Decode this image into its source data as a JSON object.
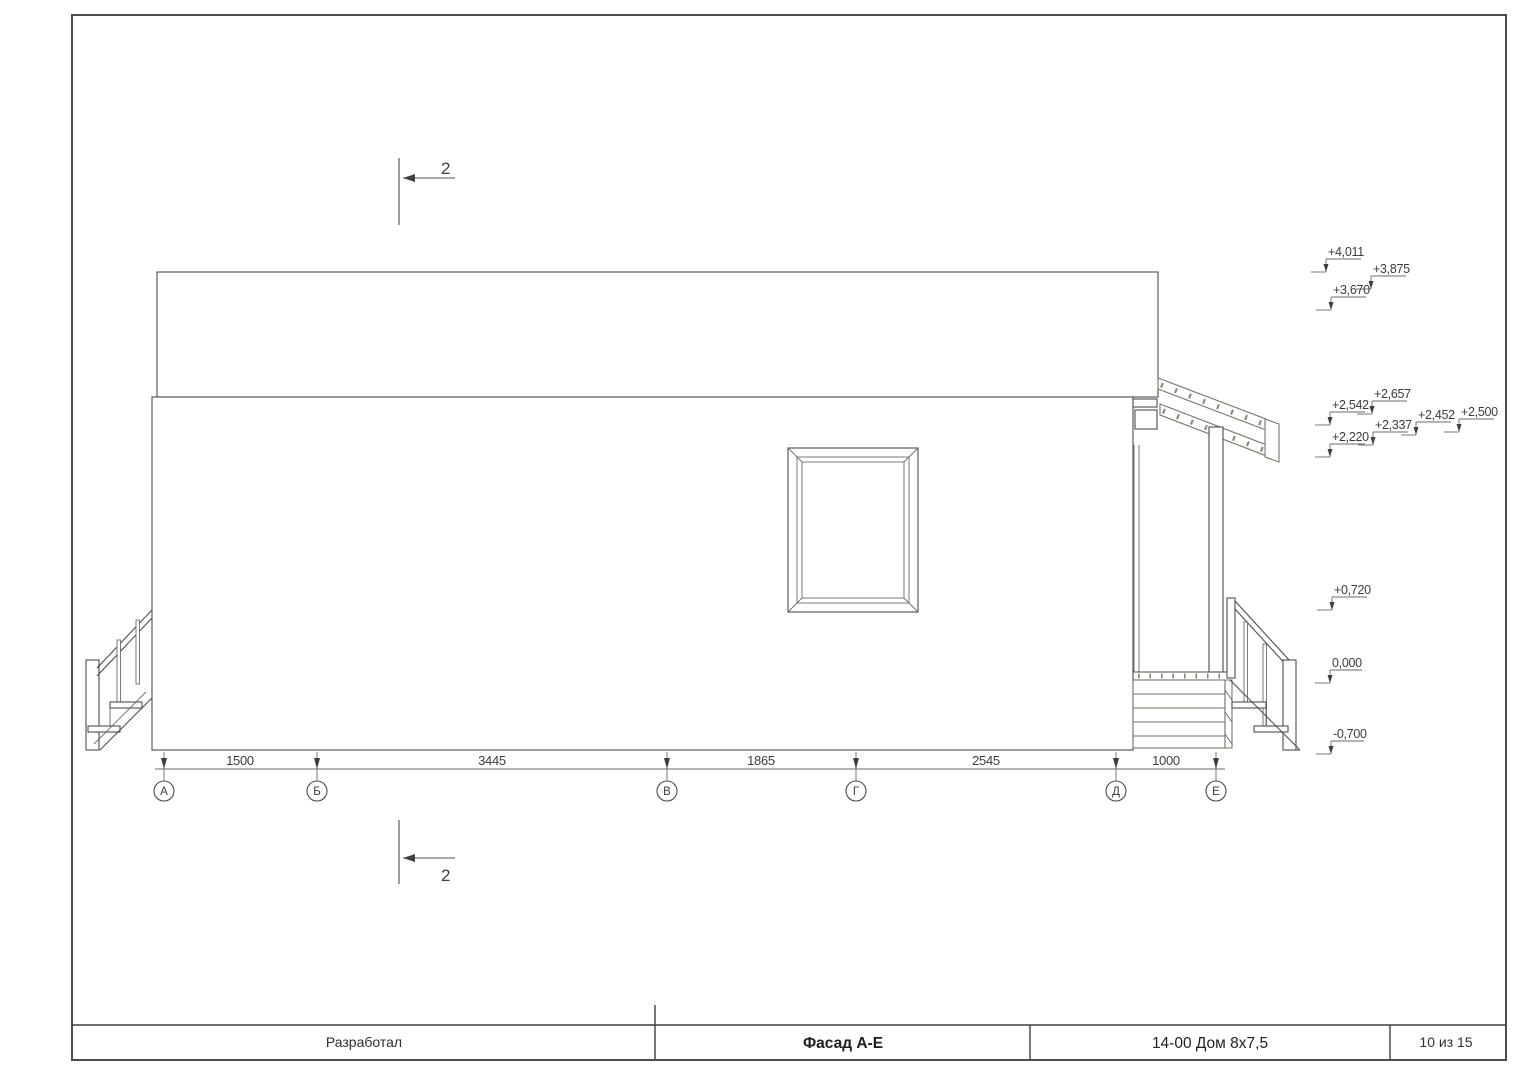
{
  "title_block": {
    "developer_label": "Разработал",
    "drawing_title": "Фасад А-Е",
    "project_code": "14-00 Дом 8х7,5",
    "sheet_info": "10 из 15"
  },
  "section_marker": {
    "label": "2"
  },
  "axes": [
    {
      "label": "А"
    },
    {
      "label": "Б"
    },
    {
      "label": "В"
    },
    {
      "label": "Г"
    },
    {
      "label": "Д"
    },
    {
      "label": "Е"
    }
  ],
  "dims": {
    "segments": [
      {
        "from": "А",
        "to": "Б",
        "value": "1500"
      },
      {
        "from": "Б",
        "to": "В",
        "value": "3445"
      },
      {
        "from": "В",
        "to": "Г",
        "value": "1865"
      },
      {
        "from": "Г",
        "to": "Д",
        "value": "2545"
      },
      {
        "from": "Д",
        "to": "Е",
        "value": "1000"
      }
    ]
  },
  "elevations": [
    {
      "label": "+4,011"
    },
    {
      "label": "+3,875"
    },
    {
      "label": "+3,670"
    },
    {
      "label": "+2,657"
    },
    {
      "label": "+2,542"
    },
    {
      "label": "+2,500"
    },
    {
      "label": "+2,452"
    },
    {
      "label": "+2,337"
    },
    {
      "label": "+2,220"
    },
    {
      "label": "+0,720"
    },
    {
      "label": "0,000"
    },
    {
      "label": "-0,700"
    }
  ],
  "colors": {
    "line": "#4d4d4d",
    "wood_line": "#7d7266",
    "background": "#ffffff"
  }
}
